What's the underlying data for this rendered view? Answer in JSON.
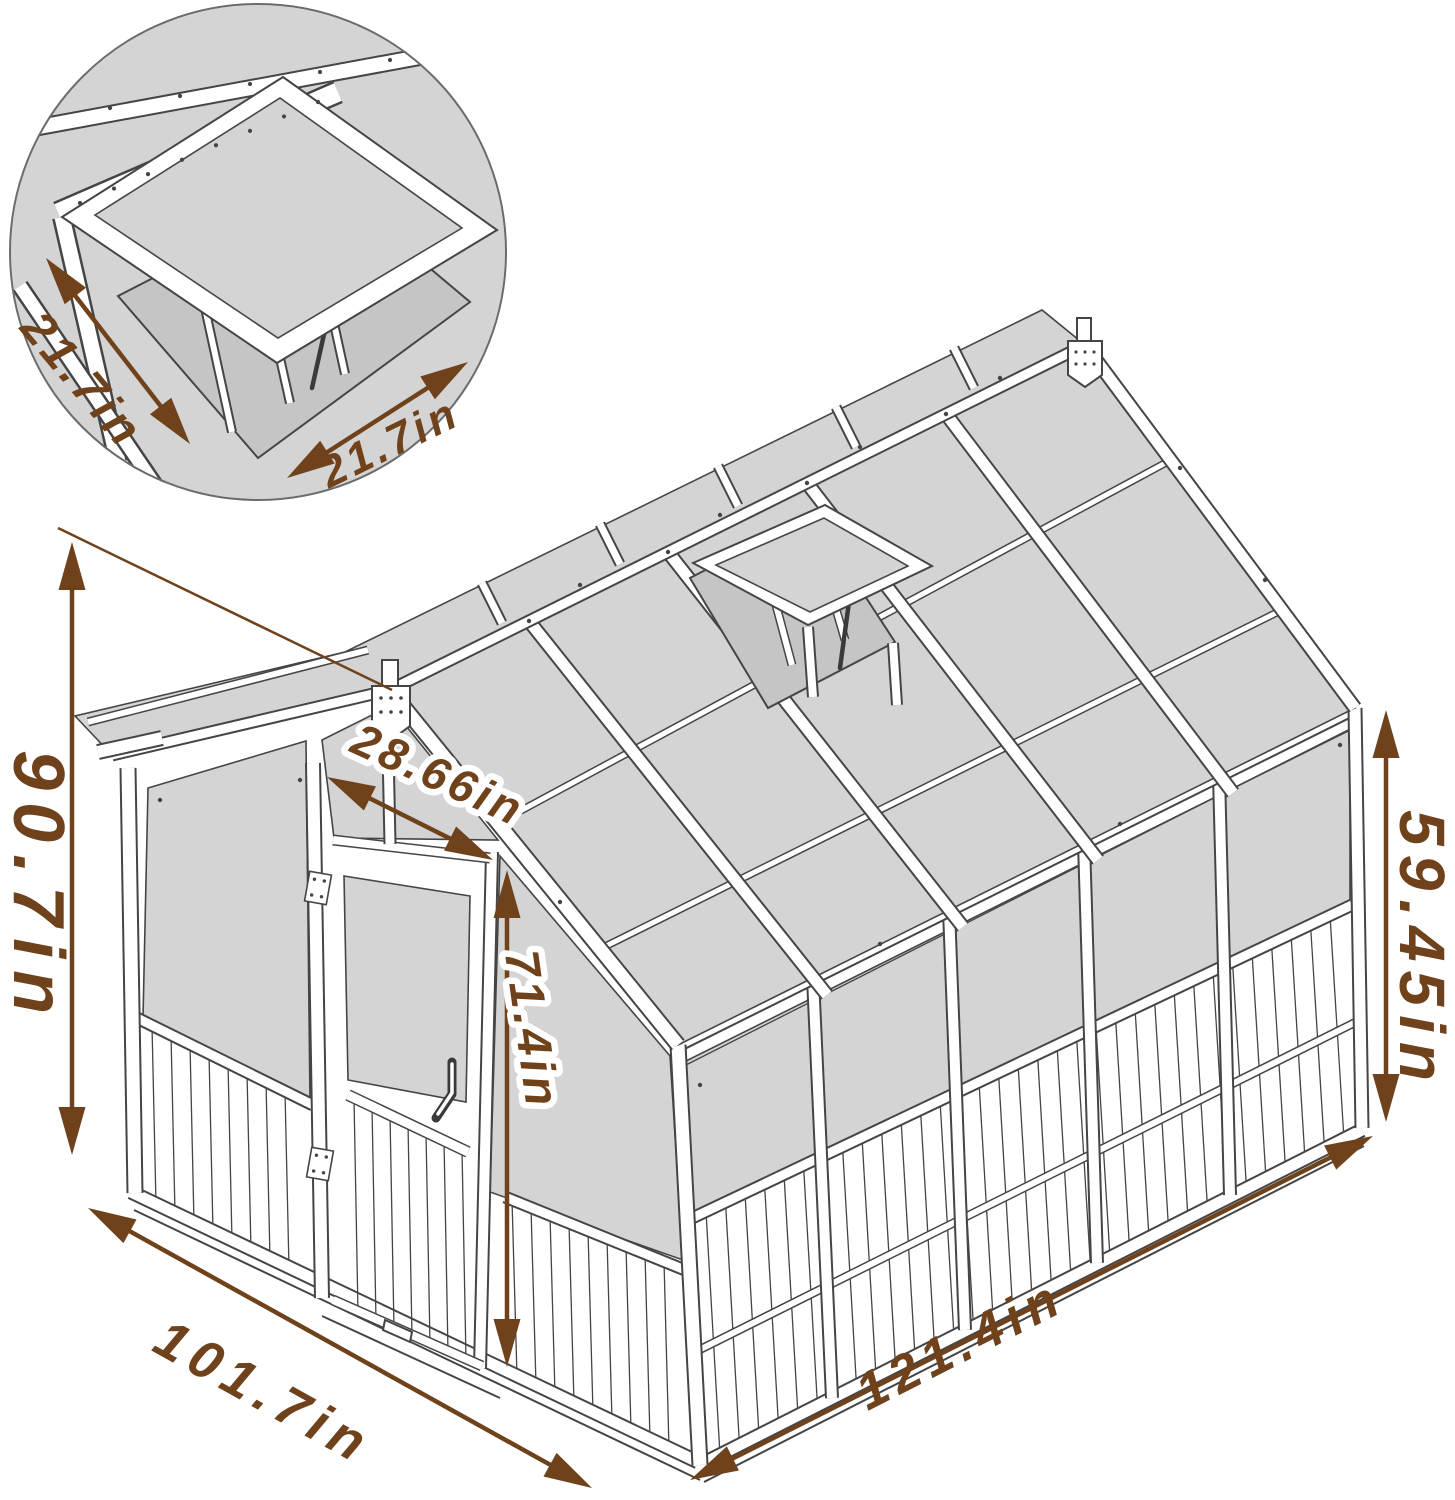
{
  "figure": {
    "type": "product-dimension-diagram",
    "subject": "wooden greenhouse with polycarbonate panels, open roof vent and hinged door",
    "units": "in"
  },
  "colors": {
    "dimension": "#6f421c",
    "line": "#454545",
    "panel": "#d4d4d4",
    "panel_dark": "#c5c5c5",
    "background": "#ffffff",
    "inset_ring": "#6b6b6b"
  },
  "inset": {
    "content": "close-up detail of the open roof vent window"
  },
  "dimensions": [
    {
      "id": "roof-vent-width-left",
      "label": "21.7in",
      "value": 21.7,
      "text": {
        "x": 70,
        "y": 390,
        "rotate": 50,
        "size": 48,
        "spacing": 4,
        "halo": false
      },
      "arrow": {
        "x1": 46,
        "y1": 258,
        "x2": 190,
        "y2": 444
      }
    },
    {
      "id": "roof-vent-width-right",
      "label": "21.7in",
      "value": 21.7,
      "text": {
        "x": 396,
        "y": 456,
        "rotate": -26,
        "size": 44,
        "spacing": 4,
        "halo": false
      },
      "arrow": {
        "x1": 287,
        "y1": 478,
        "x2": 468,
        "y2": 362
      }
    },
    {
      "id": "overall-height",
      "label": "90.7in",
      "value": 90.7,
      "text": {
        "x": 14,
        "y": 888,
        "rotate": 90,
        "size": 72,
        "spacing": 12,
        "halo": false
      },
      "arrow": {
        "x1": 72,
        "y1": 542,
        "x2": 72,
        "y2": 1155
      },
      "aux": [
        {
          "x1": 58,
          "y1": 528,
          "x2": 392,
          "y2": 690
        }
      ]
    },
    {
      "id": "door-width",
      "label": "28.66in",
      "value": 28.66,
      "text": {
        "x": 432,
        "y": 789,
        "rotate": 24.5,
        "size": 46,
        "spacing": 4,
        "halo": true
      },
      "arrow": {
        "x1": 327,
        "y1": 777,
        "x2": 493,
        "y2": 860
      }
    },
    {
      "id": "door-height",
      "label": "71.4in",
      "value": 71.4,
      "text": {
        "x": 516,
        "y": 1032,
        "rotate": 82,
        "size": 48,
        "spacing": 4,
        "halo": true
      },
      "arrow": {
        "x1": 507,
        "y1": 870,
        "x2": 507,
        "y2": 1367
      }
    },
    {
      "id": "side-wall-height",
      "label": "59.45in",
      "value": 59.45,
      "text": {
        "x": 1400,
        "y": 950,
        "rotate": 90,
        "size": 64,
        "spacing": 9,
        "halo": false
      },
      "arrow": {
        "x1": 1386,
        "y1": 710,
        "x2": 1386,
        "y2": 1122
      }
    },
    {
      "id": "front-width",
      "label": "101.7in",
      "value": 101.7,
      "text": {
        "x": 255,
        "y": 1408,
        "rotate": 29,
        "size": 54,
        "spacing": 8,
        "halo": false
      },
      "arrow": {
        "x1": 88,
        "y1": 1208,
        "x2": 592,
        "y2": 1488
      }
    },
    {
      "id": "side-depth",
      "label": "121.4in",
      "value": 121.4,
      "text": {
        "x": 968,
        "y": 1360,
        "rotate": -27,
        "size": 52,
        "spacing": 7,
        "halo": false
      },
      "arrow": {
        "x1": 690,
        "y1": 1480,
        "x2": 1373,
        "y2": 1136
      }
    }
  ]
}
